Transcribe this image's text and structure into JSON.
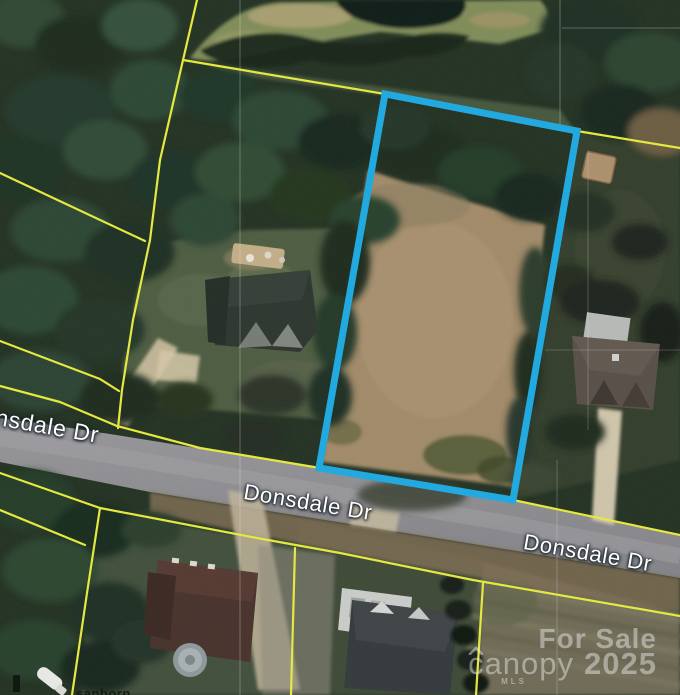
{
  "map": {
    "type": "satellite-aerial",
    "street_labels": [
      {
        "text": "nsdale Dr"
      },
      {
        "text": "Donsdale Dr"
      },
      {
        "text": "Donsdale Dr"
      }
    ],
    "watermark": {
      "line1": "For Sale",
      "brand": "canopy",
      "brand_sub": "MLS",
      "year": "2025"
    },
    "attribution": {
      "text": "sanborn"
    },
    "colors": {
      "parcel_line": "#e6ea3c",
      "highlight_lot": "#1ca9e1",
      "street_label_fill": "#ffffff",
      "watermark_fill": "rgba(238,240,240,0.46)"
    }
  }
}
